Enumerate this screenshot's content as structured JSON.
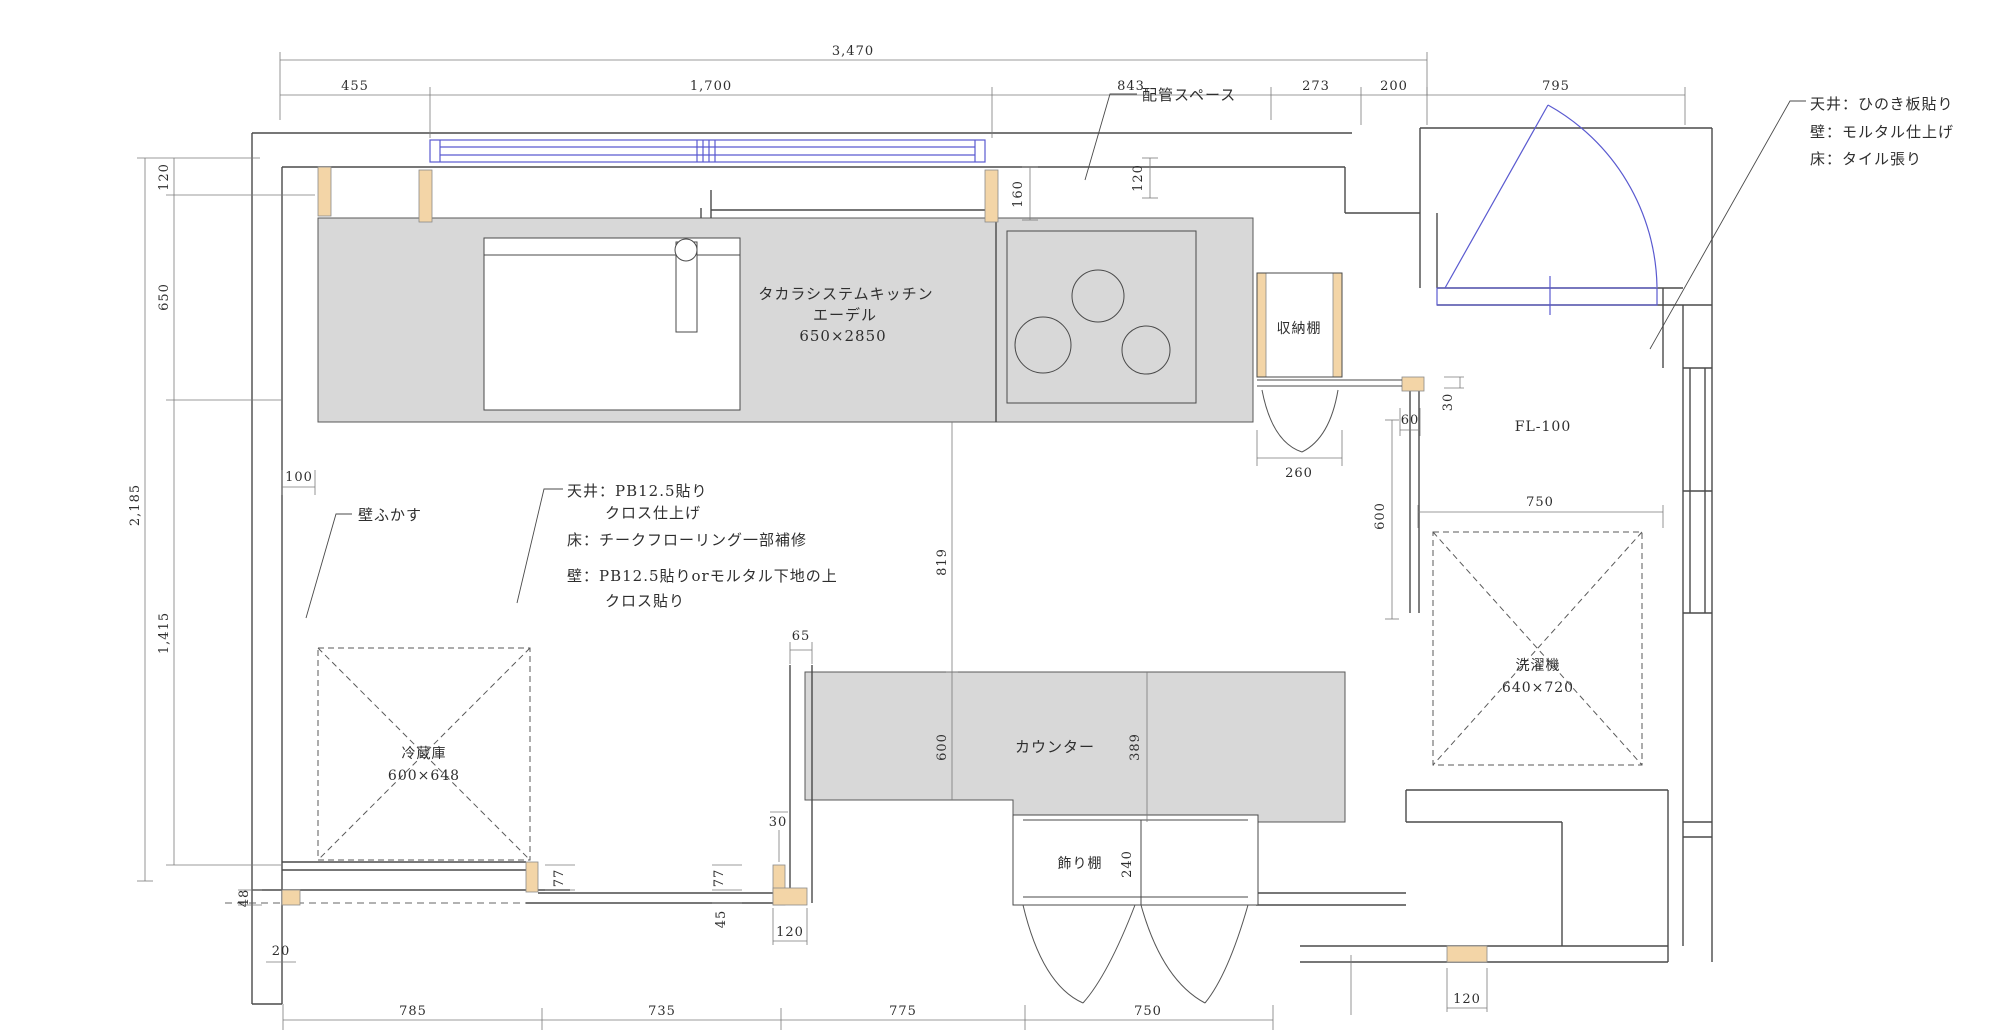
{
  "drawing": {
    "type": "kitchen-floor-plan",
    "colors": {
      "line": "#4a4a4a",
      "thin_line": "#8a8a8a",
      "gray_fill": "#d8d8d8",
      "tan_fill": "#f3d5a7",
      "blue": "#5a5ad0",
      "text": "#2e2e2e"
    },
    "labels": {
      "pipe_space": "配管スペース",
      "kitchen_line1": "タカラシステムキッチン",
      "kitchen_line2": "エーデル",
      "kitchen_line3": "650×2850",
      "storage_shelf": "収納棚",
      "wall_fukasu": "壁ふかす",
      "fl_100": "FL-100",
      "display_shelf": "飾り棚",
      "counter": "カウンター",
      "fridge_line1": "冷蔵庫",
      "fridge_line2": "600×648",
      "washer_line1": "洗濯機",
      "washer_line2": "640×720",
      "room_spec_line1": "天井：PB12.5貼り",
      "room_spec_line2": "クロス仕上げ",
      "room_spec_line3": "床：チークフローリング一部補修",
      "room_spec_line4": "壁：PB12.5貼りorモルタル下地の上",
      "room_spec_line5": "クロス貼り",
      "tile_spec_line1": "天井：ひのき板貼り",
      "tile_spec_line2": "壁：モルタル仕上げ",
      "tile_spec_line3": "床：タイル張り"
    },
    "dims": {
      "top_total": "3,470",
      "top_1": "455",
      "top_2": "1,700",
      "top_3": "843",
      "top_4": "273",
      "top_5": "200",
      "top_6": "795",
      "left_1": "120",
      "left_2": "650",
      "left_total": "2,185",
      "left_3": "1,415",
      "left_4": "48",
      "left_5": "20",
      "wall_offset": "100",
      "v_160": "160",
      "v_120_pipe": "120",
      "h_260": "260",
      "h_60": "60",
      "v_30_niche": "30",
      "v_600_niche": "600",
      "h_750_niche": "750",
      "v_819": "819",
      "v_600_counter": "600",
      "v_389": "389",
      "v_240": "240",
      "h_65": "65",
      "v_30_counter": "30",
      "v_77_left": "77",
      "v_77_right": "77",
      "v_45": "45",
      "h_120_counter": "120",
      "h_120_washer": "120",
      "bottom_1": "785",
      "bottom_2": "735",
      "bottom_3": "775",
      "bottom_4": "750"
    }
  }
}
